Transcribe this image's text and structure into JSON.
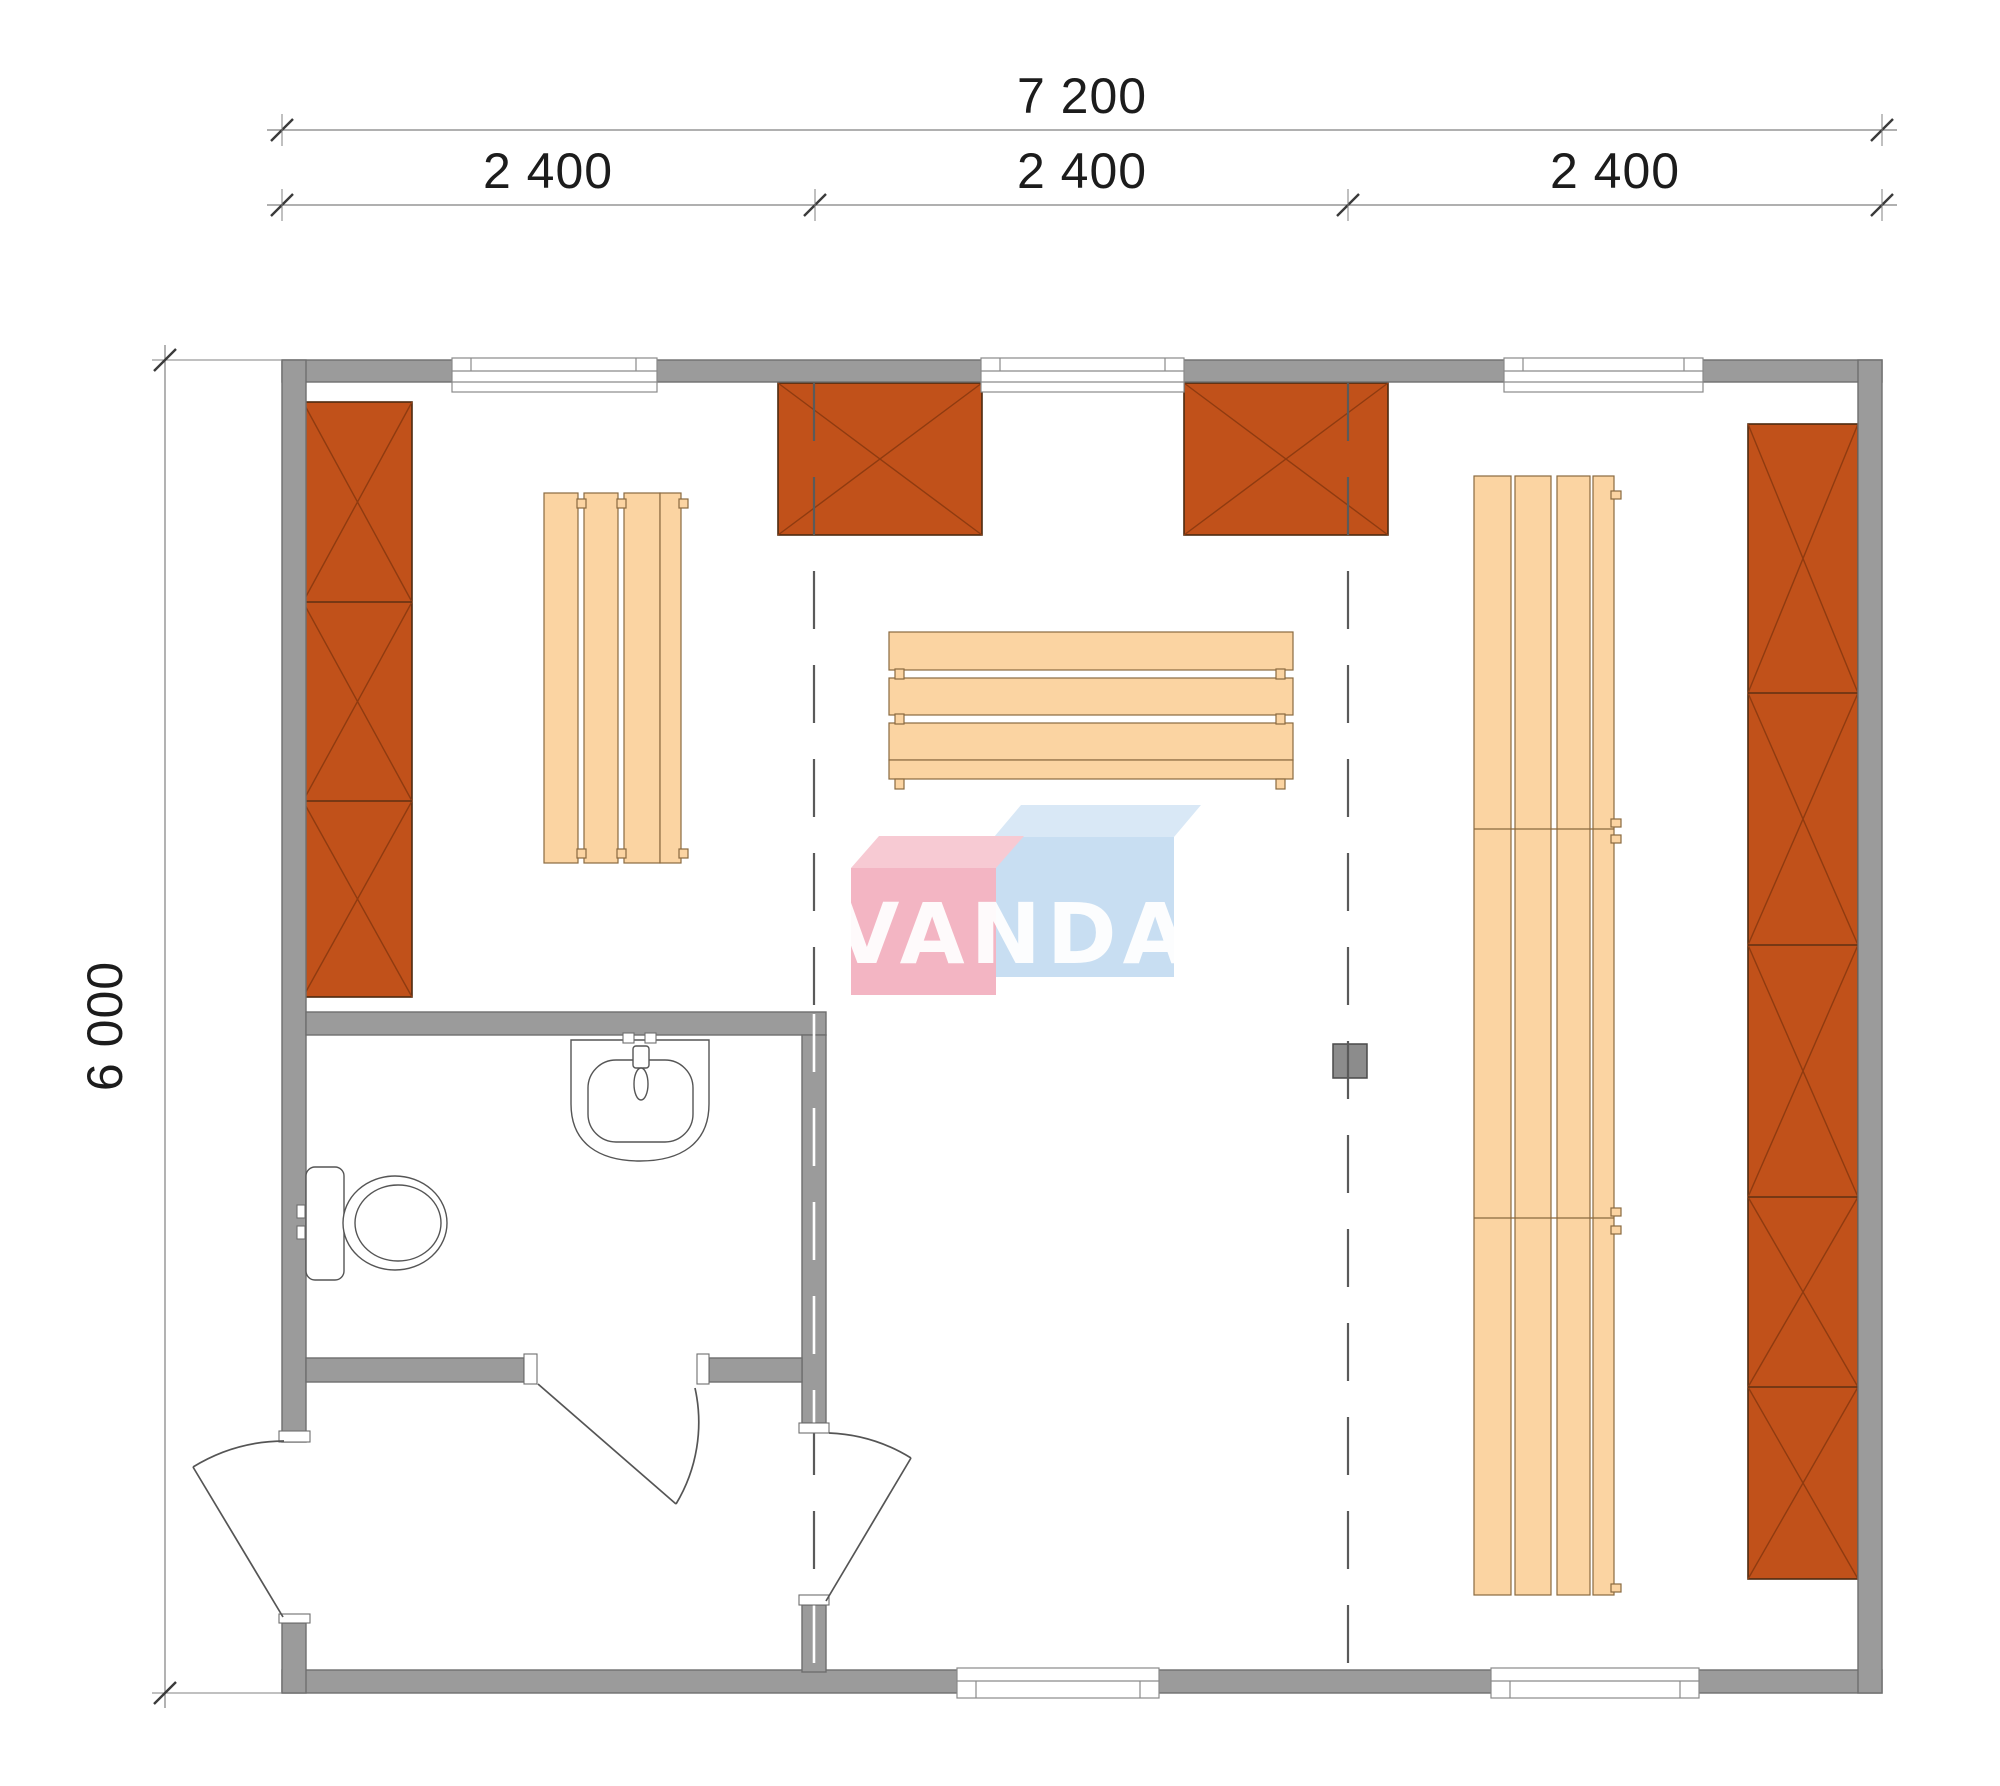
{
  "dimensions": {
    "total_width": "7 200",
    "bay_widths": [
      "2 400",
      "2 400",
      "2 400"
    ],
    "total_height": "6 000"
  },
  "logo": {
    "text": "VANDA"
  },
  "colors": {
    "wall": "#9B9B9B",
    "wallEdge": "#6E6E6E",
    "cabinet": "#C1511A",
    "cabinetLine": "#8F3B10",
    "cabinetEdge": "#4D2A10",
    "bench": "#FBD4A2",
    "benchEdge": "#8A6A40",
    "stove": "#8C8C8C",
    "stoveEdge": "#4A4A4A",
    "line": "#555555",
    "dim": "#3A3A3A",
    "dimLine": "#808080",
    "moduleLine": "#5A5A5A",
    "windowFrame": "#8A8A8A",
    "logoPink": "#F2AFBE",
    "logoPinkTop": "#F7C6D0",
    "logoBlue": "#C4DCF1",
    "logoBlueTop": "#D6E7F6",
    "logoText": "#FFFFFF"
  }
}
